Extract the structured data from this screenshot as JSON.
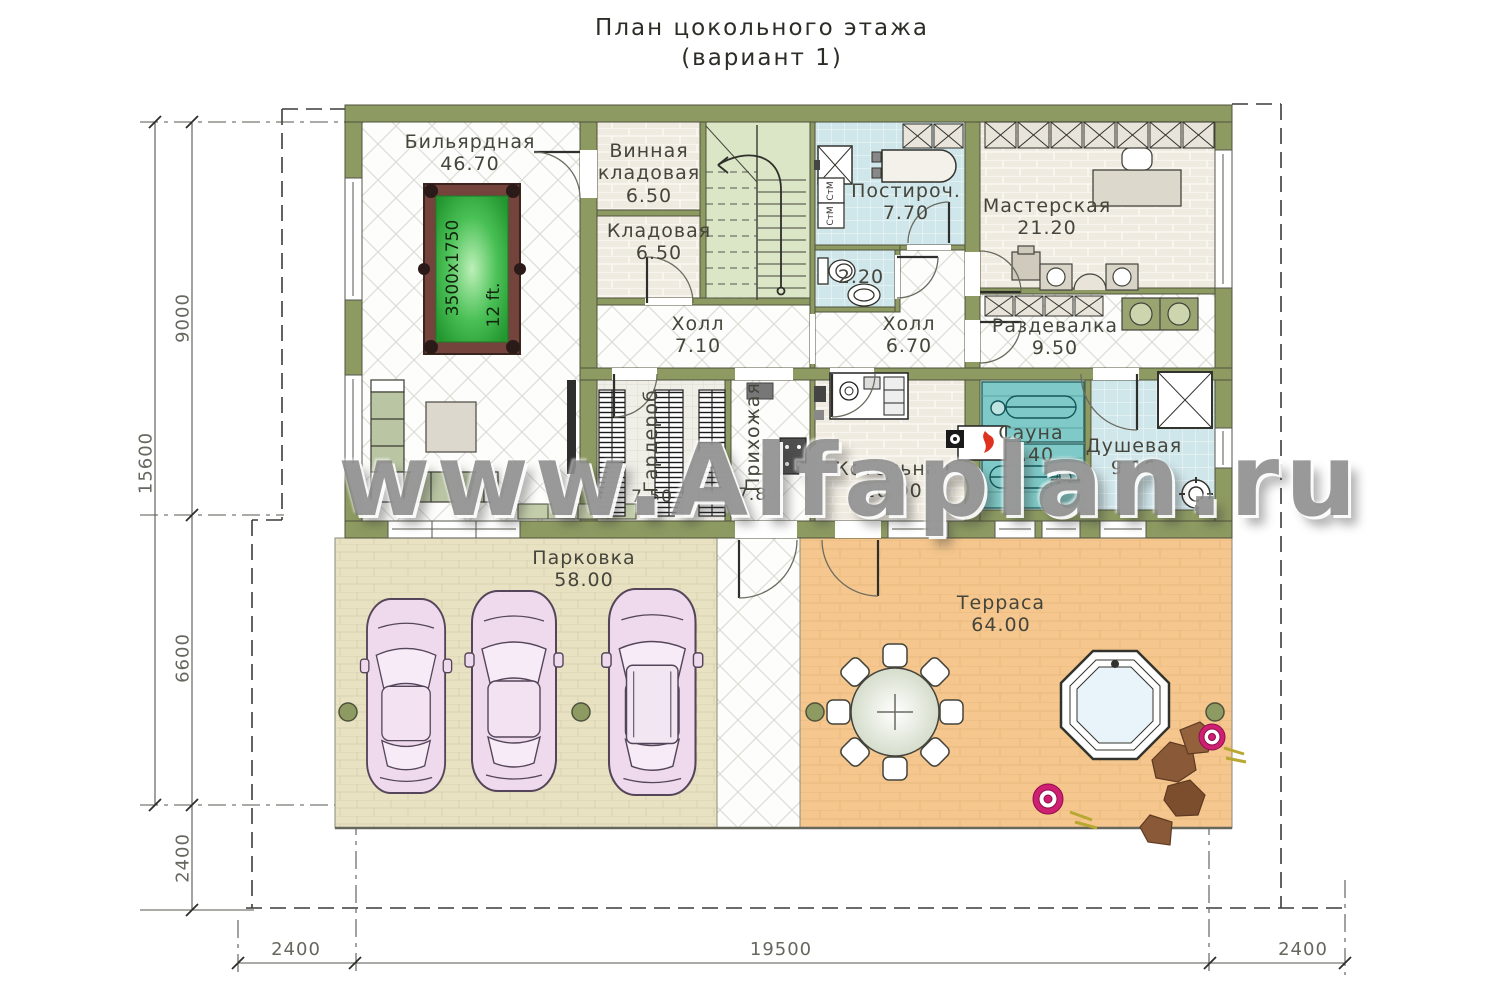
{
  "title": {
    "line1": "План цокольного этажа",
    "line2": "(вариант 1)"
  },
  "watermark": "www.Alfaplan.ru",
  "rooms": {
    "billiard": {
      "name": "Бильярдная",
      "area": "46.70"
    },
    "wine_storage": {
      "name": "Винная кладовая",
      "area": "6.50"
    },
    "storage": {
      "name": "Кладовая",
      "area": "6.50"
    },
    "hall_left": {
      "name": "Холл",
      "area": "7.10"
    },
    "laundry": {
      "name": "Постироч.",
      "area": "7.70"
    },
    "wc": {
      "area": "2.20"
    },
    "hall_right": {
      "name": "Холл",
      "area": "6.70"
    },
    "workshop": {
      "name": "Мастерская",
      "area": "21.20"
    },
    "changing_room": {
      "name": "Раздевалка",
      "area": "9.50"
    },
    "sauna": {
      "name": "Сауна",
      "area": "8.40"
    },
    "shower": {
      "name": "Душевая",
      "area": "9.10"
    },
    "wardrobe": {
      "name": "Гардероб",
      "area": "7.50"
    },
    "entry_hall": {
      "name": "Прихожая",
      "area": "7.80"
    },
    "boiler_room": {
      "name": "Котельная",
      "area": "10.00"
    },
    "parking": {
      "name": "Парковка",
      "area": "58.00"
    },
    "terrace": {
      "name": "Терраса",
      "area": "64.00"
    }
  },
  "billiard_table": {
    "size_label": "3500x1750",
    "length_label": "12 ft."
  },
  "appliances": {
    "washers": [
      "СтМ",
      "СтМ"
    ]
  },
  "dimensions": {
    "left": {
      "total": "15600",
      "upper": "9000",
      "middle": "6600",
      "lower": "2400"
    },
    "bottom": {
      "left": "2400",
      "center": "19500",
      "right": "2400"
    }
  },
  "colors": {
    "wall": "#8d9b62",
    "parking_slab": "#e8e2c3",
    "terrace": "#f5c78e",
    "sauna": "#7fcac8",
    "wet_tile": "#cfe6ea",
    "billiard_cloth": "#35b34a",
    "car_body": "#eedaec",
    "watermark_gray": "#8a8a8a",
    "flower_pink": "#cf1f72",
    "rock_brown": "#8a5a38"
  }
}
